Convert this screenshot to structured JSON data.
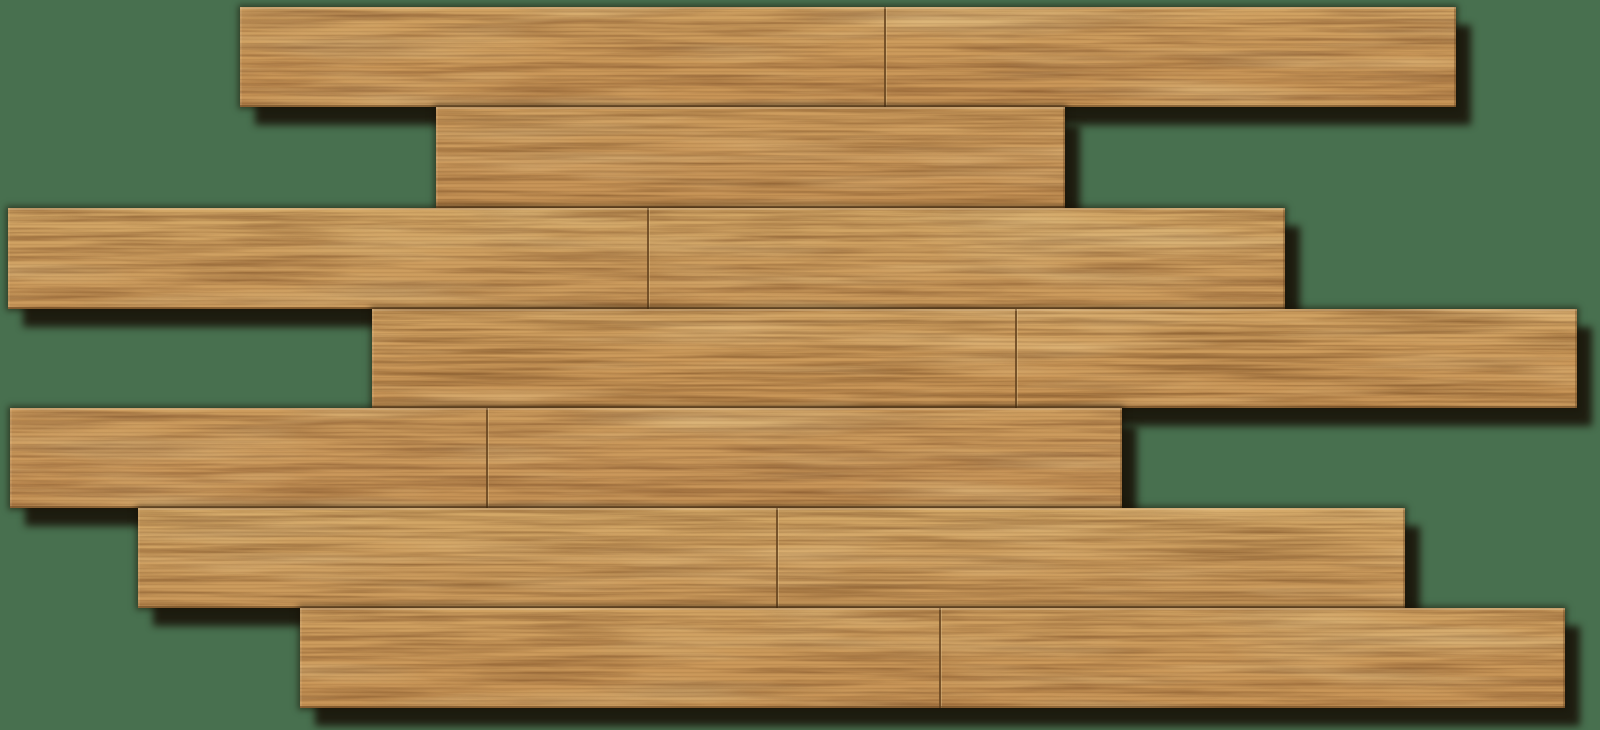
{
  "scene": {
    "title": "Honey oak wood flooring planks laid in a staggered brick pattern on a green background",
    "background_color": "#48704f",
    "canvas": {
      "width": 1600,
      "height": 730
    },
    "palette": {
      "wood_base": "#cb9a5c",
      "wood_base_light": "#d4a96b",
      "wood_streak_light": "#e0bc7f",
      "wood_grain_dark": "#9a6f3c",
      "seam_line": "#7d5830",
      "shadow": "#17100a"
    },
    "shadow_offset": {
      "x": 15,
      "y": 18,
      "opacity": 0.85
    },
    "planks": [
      {
        "row": 1,
        "x": 240,
        "y": 7,
        "width": 1216,
        "height": 100,
        "seams_x": [
          885
        ]
      },
      {
        "row": 2,
        "x": 436,
        "y": 107,
        "width": 629,
        "height": 101,
        "seams_x": []
      },
      {
        "row": 3,
        "x": 8,
        "y": 208,
        "width": 1277,
        "height": 101,
        "seams_x": [
          648
        ]
      },
      {
        "row": 4,
        "x": 372,
        "y": 309,
        "width": 1205,
        "height": 99,
        "seams_x": [
          1016
        ]
      },
      {
        "row": 5,
        "x": 10,
        "y": 408,
        "width": 1112,
        "height": 100,
        "seams_x": [
          487
        ]
      },
      {
        "row": 6,
        "x": 138,
        "y": 508,
        "width": 1267,
        "height": 100,
        "seams_x": [
          777
        ]
      },
      {
        "row": 7,
        "x": 300,
        "y": 608,
        "width": 1265,
        "height": 100,
        "seams_x": [
          940
        ]
      }
    ]
  }
}
